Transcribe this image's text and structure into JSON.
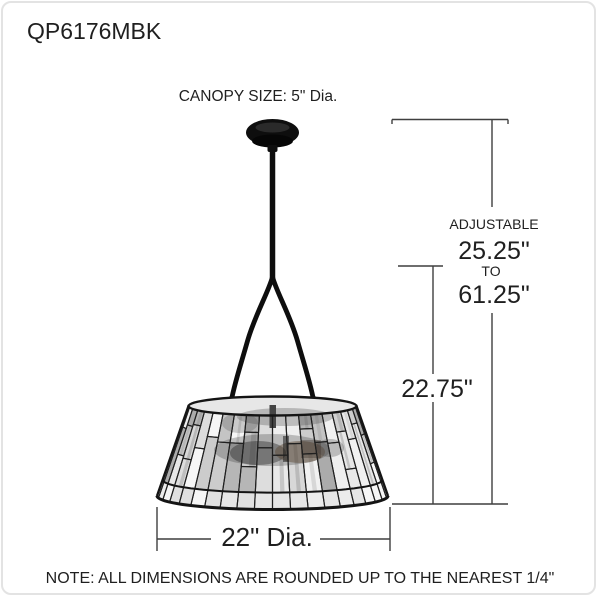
{
  "header": {
    "model": "QP6176MBK"
  },
  "diagram": {
    "canopy_label": "CANOPY SIZE:  5\" Dia.",
    "adjustable_label": "ADJUSTABLE",
    "adjustable_min": "25.25\"",
    "range_connector": "TO",
    "adjustable_max": "61.25\"",
    "fixture_height": "22.75\"",
    "shade_diameter": "22\" Dia."
  },
  "footer": {
    "note": "NOTE: ALL DIMENSIONS ARE ROUNDED UP TO THE NEAREST 1/4\""
  },
  "colors": {
    "dimension_line": "#3f3f3f",
    "text": "#1f1f1f",
    "fixture_black": "#0e0e0e",
    "card_border": "#e3e3e3",
    "tile_stroke": "#202020",
    "shade_base": "#f3f3f3",
    "shade_opening": "#e7e7e7"
  },
  "shade_palette": [
    "#f6f6f6",
    "#efefef",
    "#e7e7e7",
    "#dddddd",
    "#d0d0d0",
    "#c4c4c4",
    "#b6b6b6",
    "#ababab",
    "#e9e9e9",
    "#f1f1f1",
    "#d8d8d8",
    "#cccccc"
  ],
  "shade_band_palette": [
    "#f2f2f2",
    "#ececec",
    "#e6e6e6",
    "#f6f6f6",
    "#e0e0e0"
  ]
}
